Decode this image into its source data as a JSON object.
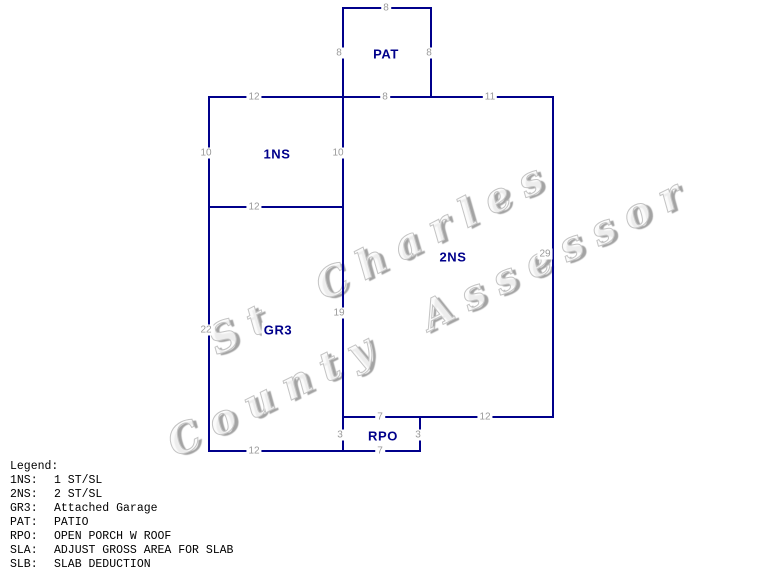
{
  "watermark": {
    "line1": "St Charles",
    "line2": "County Assessor"
  },
  "sketch": {
    "line_color": "#00008B",
    "area_label_color": "#00008B",
    "dimension_label_color": "#9a9a9a",
    "segments": [
      {
        "x": 342,
        "y": 7,
        "w": 90,
        "h": 2
      },
      {
        "x": 209,
        "y": 96,
        "w": 345,
        "h": 2
      },
      {
        "x": 209,
        "y": 206,
        "w": 135,
        "h": 2
      },
      {
        "x": 342,
        "y": 416,
        "w": 212,
        "h": 2
      },
      {
        "x": 209,
        "y": 450,
        "w": 212,
        "h": 2
      },
      {
        "x": 208,
        "y": 96,
        "w": 2,
        "h": 356
      },
      {
        "x": 342,
        "y": 7,
        "w": 2,
        "h": 445
      },
      {
        "x": 430,
        "y": 7,
        "w": 2,
        "h": 91
      },
      {
        "x": 552,
        "y": 96,
        "w": 2,
        "h": 322
      },
      {
        "x": 419,
        "y": 416,
        "w": 2,
        "h": 36
      }
    ],
    "area_labels": [
      {
        "id": "pat",
        "text": "PAT",
        "x": 386,
        "y": 54
      },
      {
        "id": "1ns",
        "text": "1NS",
        "x": 277,
        "y": 154
      },
      {
        "id": "2ns",
        "text": "2NS",
        "x": 453,
        "y": 257
      },
      {
        "id": "gr3",
        "text": "GR3",
        "x": 278,
        "y": 330
      },
      {
        "id": "rpo",
        "text": "RPO",
        "x": 383,
        "y": 436
      }
    ],
    "dimension_labels": [
      {
        "text": "8",
        "x": 386,
        "y": 8
      },
      {
        "text": "8",
        "x": 339,
        "y": 53
      },
      {
        "text": "8",
        "x": 429,
        "y": 53
      },
      {
        "text": "8",
        "x": 385,
        "y": 97
      },
      {
        "text": "12",
        "x": 254,
        "y": 97
      },
      {
        "text": "11",
        "x": 490,
        "y": 97
      },
      {
        "text": "10",
        "x": 206,
        "y": 153
      },
      {
        "text": "10",
        "x": 338,
        "y": 153
      },
      {
        "text": "12",
        "x": 254,
        "y": 207
      },
      {
        "text": "29",
        "x": 545,
        "y": 254
      },
      {
        "text": "19",
        "x": 339,
        "y": 313
      },
      {
        "text": "22",
        "x": 206,
        "y": 330
      },
      {
        "text": "7",
        "x": 380,
        "y": 417
      },
      {
        "text": "12",
        "x": 485,
        "y": 417
      },
      {
        "text": "3",
        "x": 340,
        "y": 435
      },
      {
        "text": "3",
        "x": 418,
        "y": 435
      },
      {
        "text": "7",
        "x": 380,
        "y": 451
      },
      {
        "text": "12",
        "x": 254,
        "y": 451
      }
    ]
  },
  "legend": {
    "heading": "Legend:",
    "entries": [
      {
        "code": "1NS:",
        "desc": "1 ST/SL"
      },
      {
        "code": "2NS:",
        "desc": "2 ST/SL"
      },
      {
        "code": "GR3:",
        "desc": "Attached Garage"
      },
      {
        "code": "PAT:",
        "desc": "PATIO"
      },
      {
        "code": "RPO:",
        "desc": "OPEN PORCH W ROOF"
      },
      {
        "code": "SLA:",
        "desc": "ADJUST GROSS AREA FOR SLAB"
      },
      {
        "code": "SLB:",
        "desc": "SLAB DEDUCTION"
      }
    ]
  }
}
